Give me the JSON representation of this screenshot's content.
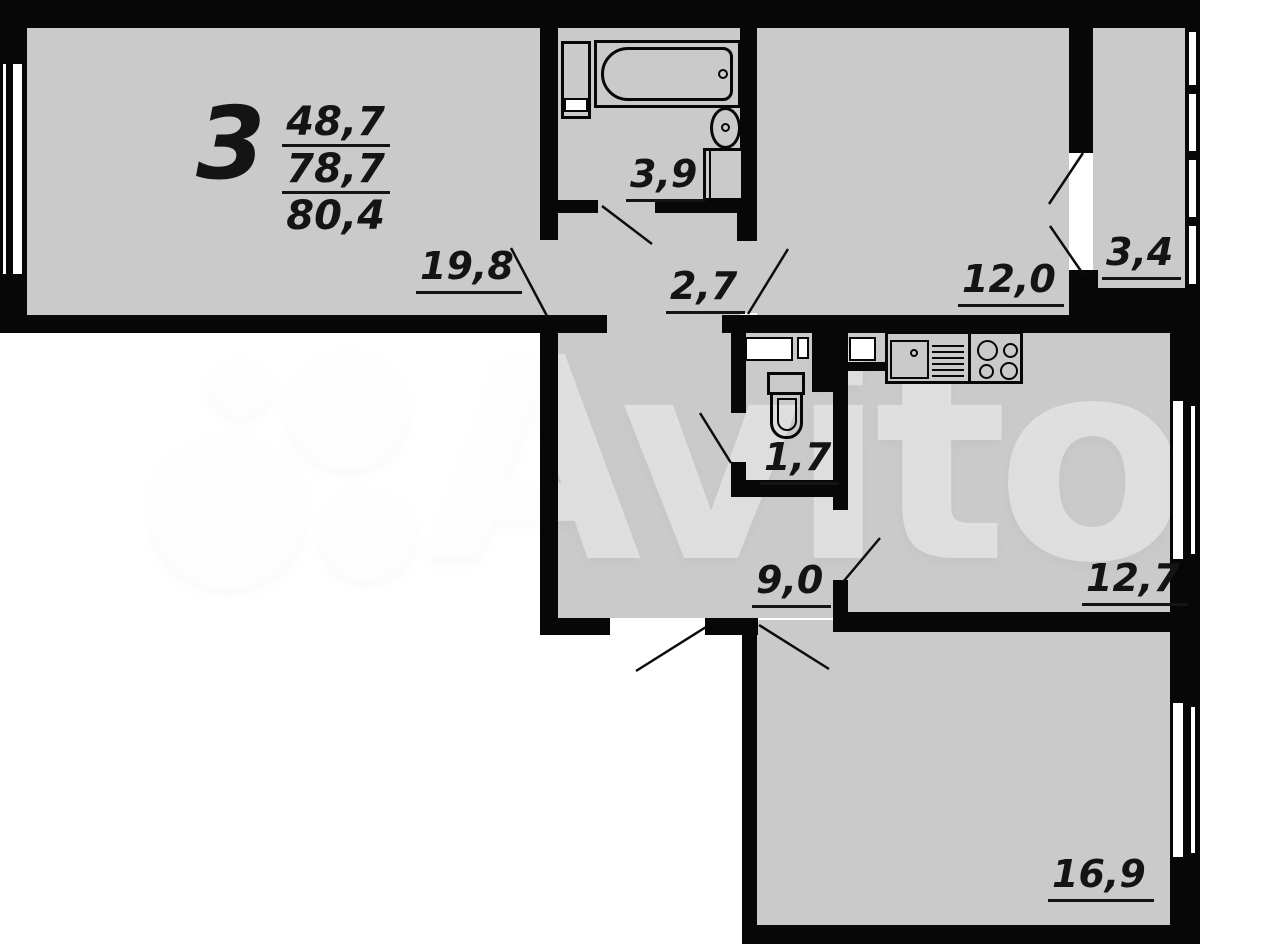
{
  "plan": {
    "title": {
      "rooms_count": "3",
      "area_living": "48,7",
      "area_no_balcony": "78,7",
      "area_total": "80,4"
    },
    "room_labels": {
      "living_room": "19,8",
      "bathroom": "3,9",
      "corridor": "2,7",
      "bedroom": "12,0",
      "loggia": "3,4",
      "wc": "1,7",
      "hallway": "9,0",
      "kitchen": "12,7",
      "bedroom2": "16,9"
    },
    "watermark": {
      "text": "Avito"
    },
    "colors": {
      "floor": "#cacaca",
      "wall": "#070707",
      "outside": "#ffffff",
      "label": "#141414"
    }
  }
}
